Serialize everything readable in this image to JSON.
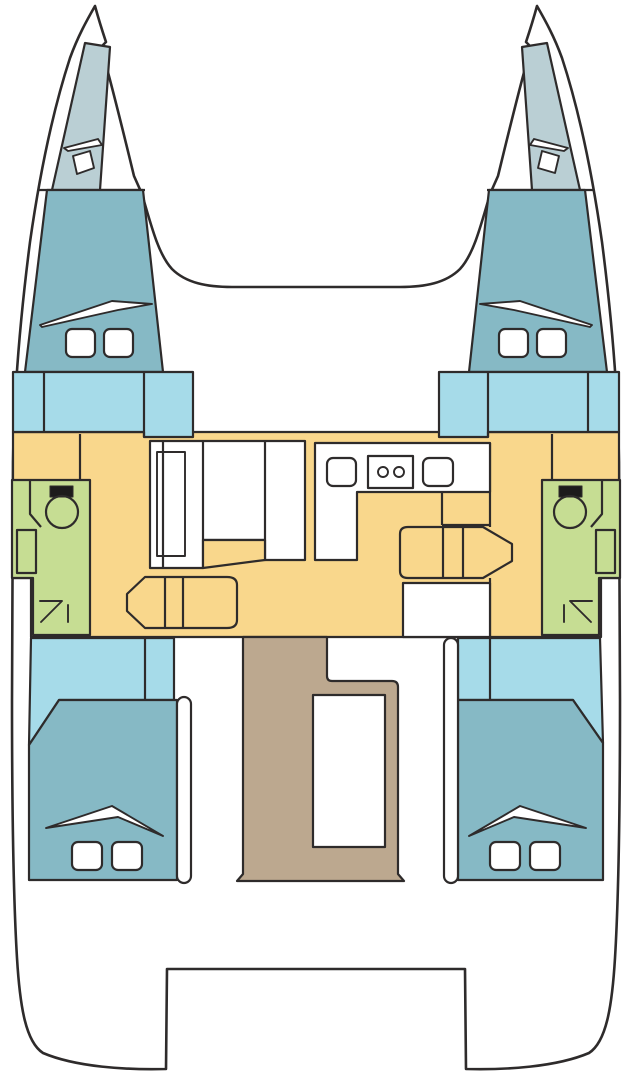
{
  "diagram": {
    "type": "catamaran-deck-plan",
    "regions": [
      {
        "name": "port-forepeak-berth",
        "color_key": "forepeak"
      },
      {
        "name": "starboard-forepeak-berth",
        "color_key": "forepeak"
      },
      {
        "name": "port-forward-cabin",
        "color_key": "cabin"
      },
      {
        "name": "starboard-forward-cabin",
        "color_key": "cabin"
      },
      {
        "name": "port-lockers",
        "color_key": "locker"
      },
      {
        "name": "starboard-lockers",
        "color_key": "locker"
      },
      {
        "name": "saloon-and-galley",
        "color_key": "salon"
      },
      {
        "name": "port-bathroom",
        "color_key": "bathroom"
      },
      {
        "name": "starboard-bathroom",
        "color_key": "bathroom"
      },
      {
        "name": "port-aft-cabin",
        "color_key": "cabin"
      },
      {
        "name": "starboard-aft-cabin",
        "color_key": "cabin"
      },
      {
        "name": "companionway-steps",
        "color_key": "stairs"
      }
    ],
    "icons": [
      "deck-hatch",
      "bed-pillow",
      "bed-duvet",
      "toilet",
      "washbasin",
      "stove-burners",
      "galley-sink",
      "shower-arrow",
      "sliding-door"
    ]
  },
  "colors": {
    "outline": "#2e2b2b",
    "hull": "#ffffff",
    "white": "#ffffff",
    "forepeak": "#bacfd4",
    "cabin": "#86b9c5",
    "locker": "#a6dbe9",
    "salon": "#f9d78c",
    "bathroom": "#c6dd93",
    "stairs": "#bca88f",
    "fixture_black": "#1d1b1b"
  }
}
